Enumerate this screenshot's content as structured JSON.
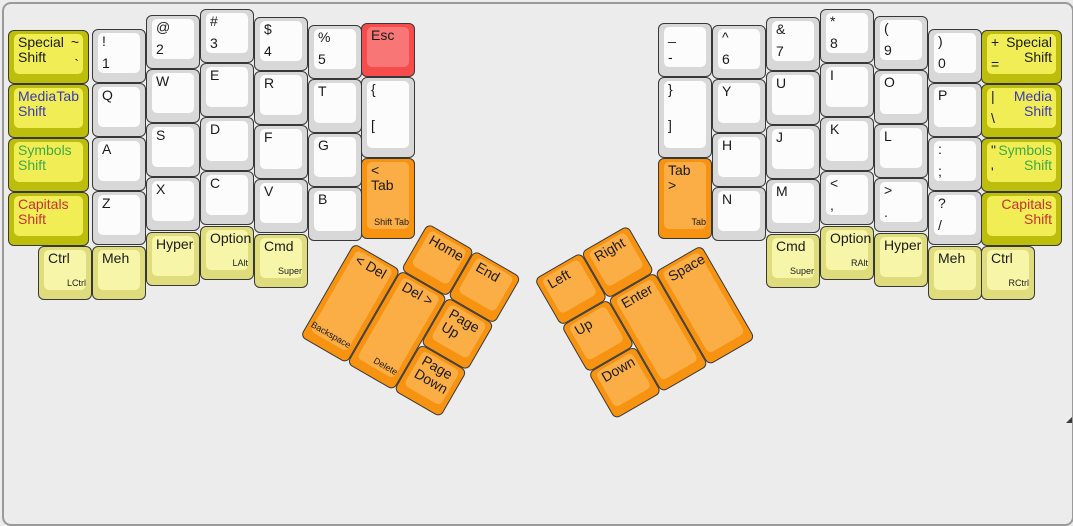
{
  "canvas": {
    "width": 1073,
    "height": 424,
    "background": "#ececec",
    "frame_border": "#9a9a9a"
  },
  "key_colors": {
    "white": {
      "base": "#d8d8d8",
      "face": "#fcfcfc"
    },
    "yellow": {
      "base": "#bdbe0b",
      "face": "#f1ee55"
    },
    "pale": {
      "base": "#dedc7d",
      "face": "#f7f6a8"
    },
    "orange": {
      "base": "#f79310",
      "face": "#fbae45"
    },
    "red": {
      "base": "#f74c4c",
      "face": "#f97676"
    }
  },
  "text_colors": {
    "black": "#1a1a1a",
    "blue": "#3939b8",
    "green": "#43a843",
    "red": "#c53232"
  },
  "unit_px": 54,
  "sections": [
    {
      "name": "left-main-keys",
      "keys": [
        {
          "id": "special-shift-left",
          "x": 8,
          "y": 30,
          "w": 81,
          "c": "yellow",
          "label": "Special\nShift",
          "pair": [
            "~",
            "`"
          ],
          "pp": "right"
        },
        {
          "id": "media-shift-left",
          "x": 8,
          "y": 84,
          "w": 81,
          "c": "yellow",
          "label": "Media\nShift",
          "lc": "blue",
          "pair": [
            "Tab"
          ],
          "pp": "right",
          "pc": "blue"
        },
        {
          "id": "symbols-shift-left",
          "x": 8,
          "y": 138,
          "w": 81,
          "c": "yellow",
          "label": "Symbols\nShift",
          "lc": "green"
        },
        {
          "id": "capitals-shift-left",
          "x": 8,
          "y": 192,
          "w": 81,
          "c": "yellow",
          "label": "Capitals\nShift",
          "lc": "red"
        },
        {
          "id": "digit-1",
          "x": 92,
          "y": 29,
          "pair": [
            "!",
            "1"
          ]
        },
        {
          "id": "letter-q",
          "x": 92,
          "y": 83,
          "label": "Q"
        },
        {
          "id": "letter-a",
          "x": 92,
          "y": 137,
          "label": "A"
        },
        {
          "id": "letter-z",
          "x": 92,
          "y": 191,
          "label": "Z"
        },
        {
          "id": "digit-2",
          "x": 146,
          "y": 15,
          "pair": [
            "@",
            "2"
          ]
        },
        {
          "id": "letter-w",
          "x": 146,
          "y": 69,
          "label": "W"
        },
        {
          "id": "letter-s",
          "x": 146,
          "y": 123,
          "label": "S"
        },
        {
          "id": "letter-x",
          "x": 146,
          "y": 177,
          "label": "X"
        },
        {
          "id": "hyper-left",
          "x": 146,
          "y": 232,
          "c": "pale",
          "label": "Hyper"
        },
        {
          "id": "digit-3",
          "x": 200,
          "y": 9,
          "pair": [
            "#",
            "3"
          ]
        },
        {
          "id": "letter-e",
          "x": 200,
          "y": 63,
          "label": "E"
        },
        {
          "id": "letter-d",
          "x": 200,
          "y": 117,
          "label": "D"
        },
        {
          "id": "letter-c",
          "x": 200,
          "y": 171,
          "label": "C"
        },
        {
          "id": "option-left",
          "x": 200,
          "y": 226,
          "c": "pale",
          "label": "Option",
          "sub": "LAlt"
        },
        {
          "id": "digit-4",
          "x": 254,
          "y": 17,
          "pair": [
            "$",
            "4"
          ]
        },
        {
          "id": "letter-r",
          "x": 254,
          "y": 71,
          "label": "R"
        },
        {
          "id": "letter-f",
          "x": 254,
          "y": 125,
          "label": "F"
        },
        {
          "id": "letter-v",
          "x": 254,
          "y": 179,
          "label": "V"
        },
        {
          "id": "cmd-left",
          "x": 254,
          "y": 234,
          "c": "pale",
          "label": "Cmd",
          "sub": "Super"
        },
        {
          "id": "digit-5",
          "x": 308,
          "y": 25,
          "pair": [
            "%",
            "5"
          ]
        },
        {
          "id": "letter-t",
          "x": 308,
          "y": 79,
          "label": "T"
        },
        {
          "id": "letter-g",
          "x": 308,
          "y": 133,
          "label": "G"
        },
        {
          "id": "letter-b",
          "x": 308,
          "y": 187,
          "label": "B"
        },
        {
          "id": "esc",
          "x": 361,
          "y": 23,
          "c": "red",
          "label": "Esc"
        },
        {
          "id": "bracket-left",
          "x": 361,
          "y": 77,
          "h": 81,
          "pair": [
            "{",
            "["
          ]
        },
        {
          "id": "shift-tab",
          "x": 361,
          "y": 158,
          "h": 81,
          "c": "orange",
          "label": "< Tab",
          "sub": "Shift Tab"
        },
        {
          "id": "ctrl-left",
          "x": 38,
          "y": 246,
          "c": "pale",
          "label": "Ctrl",
          "sub": "LCtrl"
        },
        {
          "id": "meh-left",
          "x": 92,
          "y": 246,
          "c": "pale",
          "label": "Meh"
        }
      ]
    },
    {
      "name": "left-thumb-cluster",
      "tx": 354,
      "ty": 243,
      "rot": 30,
      "keys": [
        {
          "id": "home",
          "x": 54,
          "y": -54,
          "c": "orange",
          "label": "Home"
        },
        {
          "id": "end",
          "x": 108,
          "y": -54,
          "c": "orange",
          "label": "End"
        },
        {
          "id": "backspace",
          "x": 0,
          "y": 0,
          "h": 108,
          "c": "orange",
          "label": "< Del",
          "sub": "Backspace"
        },
        {
          "id": "delete",
          "x": 54,
          "y": 0,
          "h": 108,
          "c": "orange",
          "label": "Del >",
          "sub": "Delete"
        },
        {
          "id": "page-up",
          "x": 108,
          "y": 0,
          "c": "orange",
          "label": "Page\nUp"
        },
        {
          "id": "page-down",
          "x": 108,
          "y": 54,
          "c": "orange",
          "label": "Page\nDown"
        }
      ]
    },
    {
      "name": "right-main-keys",
      "keys": [
        {
          "id": "minus",
          "x": 658,
          "y": 23,
          "pair": [
            "_",
            "-"
          ]
        },
        {
          "id": "bracket-right",
          "x": 658,
          "y": 77,
          "h": 81,
          "pair": [
            "}",
            "]"
          ]
        },
        {
          "id": "tab",
          "x": 658,
          "y": 158,
          "h": 81,
          "c": "orange",
          "label": "Tab >",
          "sub": "Tab"
        },
        {
          "id": "digit-6",
          "x": 712,
          "y": 25,
          "pair": [
            "^",
            "6"
          ]
        },
        {
          "id": "letter-y",
          "x": 712,
          "y": 79,
          "label": "Y"
        },
        {
          "id": "letter-h",
          "x": 712,
          "y": 133,
          "label": "H"
        },
        {
          "id": "letter-n",
          "x": 712,
          "y": 187,
          "label": "N"
        },
        {
          "id": "digit-7",
          "x": 766,
          "y": 17,
          "pair": [
            "&",
            "7"
          ]
        },
        {
          "id": "letter-u",
          "x": 766,
          "y": 71,
          "label": "U"
        },
        {
          "id": "letter-j",
          "x": 766,
          "y": 125,
          "label": "J"
        },
        {
          "id": "letter-m",
          "x": 766,
          "y": 179,
          "label": "M"
        },
        {
          "id": "cmd-right",
          "x": 766,
          "y": 234,
          "c": "pale",
          "label": "Cmd",
          "sub": "Super"
        },
        {
          "id": "digit-8",
          "x": 820,
          "y": 9,
          "pair": [
            "*",
            "8"
          ]
        },
        {
          "id": "letter-i",
          "x": 820,
          "y": 63,
          "label": "I"
        },
        {
          "id": "letter-k",
          "x": 820,
          "y": 117,
          "label": "K"
        },
        {
          "id": "comma",
          "x": 820,
          "y": 171,
          "pair": [
            "<",
            ","
          ]
        },
        {
          "id": "option-right",
          "x": 820,
          "y": 226,
          "c": "pale",
          "label": "Option",
          "sub": "RAlt"
        },
        {
          "id": "digit-9",
          "x": 874,
          "y": 16,
          "pair": [
            "(",
            "9"
          ]
        },
        {
          "id": "letter-o",
          "x": 874,
          "y": 70,
          "label": "O"
        },
        {
          "id": "letter-l",
          "x": 874,
          "y": 124,
          "label": "L"
        },
        {
          "id": "period",
          "x": 874,
          "y": 178,
          "pair": [
            ">",
            "."
          ]
        },
        {
          "id": "hyper-right",
          "x": 874,
          "y": 233,
          "c": "pale",
          "label": "Hyper"
        },
        {
          "id": "digit-0",
          "x": 928,
          "y": 29,
          "pair": [
            ")",
            "0"
          ]
        },
        {
          "id": "letter-p",
          "x": 928,
          "y": 83,
          "label": "P"
        },
        {
          "id": "semicolon",
          "x": 928,
          "y": 137,
          "pair": [
            ":",
            ";"
          ]
        },
        {
          "id": "slash",
          "x": 928,
          "y": 191,
          "pair": [
            "?",
            "/"
          ]
        },
        {
          "id": "meh-right",
          "x": 928,
          "y": 246,
          "c": "pale",
          "label": "Meh"
        },
        {
          "id": "special-shift-right",
          "x": 981,
          "y": 30,
          "w": 81,
          "c": "yellow",
          "label": "Special\nShift",
          "align": "right",
          "pair": [
            "+",
            "="
          ]
        },
        {
          "id": "media-shift-right",
          "x": 981,
          "y": 84,
          "w": 81,
          "c": "yellow",
          "label": "Media\nShift",
          "lc": "blue",
          "align": "right",
          "pair": [
            "|",
            "\\"
          ]
        },
        {
          "id": "symbols-shift-right",
          "x": 981,
          "y": 138,
          "w": 81,
          "c": "yellow",
          "label": "Symbols\nShift",
          "lc": "green",
          "align": "right",
          "pair": [
            "\"",
            "'"
          ]
        },
        {
          "id": "capitals-shift-right",
          "x": 981,
          "y": 192,
          "w": 81,
          "c": "yellow",
          "label": "Capitals\nShift",
          "lc": "red",
          "align": "right"
        },
        {
          "id": "ctrl-right",
          "x": 981,
          "y": 246,
          "c": "pale",
          "label": "Ctrl",
          "sub": "RCtrl"
        }
      ]
    },
    {
      "name": "right-thumb-cluster",
      "tx": 561,
      "ty": 326,
      "rot": -30,
      "keys": [
        {
          "id": "arrow-left",
          "x": 0,
          "y": -54,
          "c": "orange",
          "label": "Left"
        },
        {
          "id": "arrow-right",
          "x": 54,
          "y": -54,
          "c": "orange",
          "label": "Right"
        },
        {
          "id": "arrow-up",
          "x": 0,
          "y": 0,
          "c": "orange",
          "label": "Up"
        },
        {
          "id": "arrow-down",
          "x": 0,
          "y": 54,
          "c": "orange",
          "label": "Down"
        },
        {
          "id": "enter",
          "x": 54,
          "y": 0,
          "h": 108,
          "c": "orange",
          "label": "Enter"
        },
        {
          "id": "space",
          "x": 108,
          "y": 0,
          "h": 108,
          "c": "orange",
          "label": "Space"
        }
      ]
    }
  ]
}
